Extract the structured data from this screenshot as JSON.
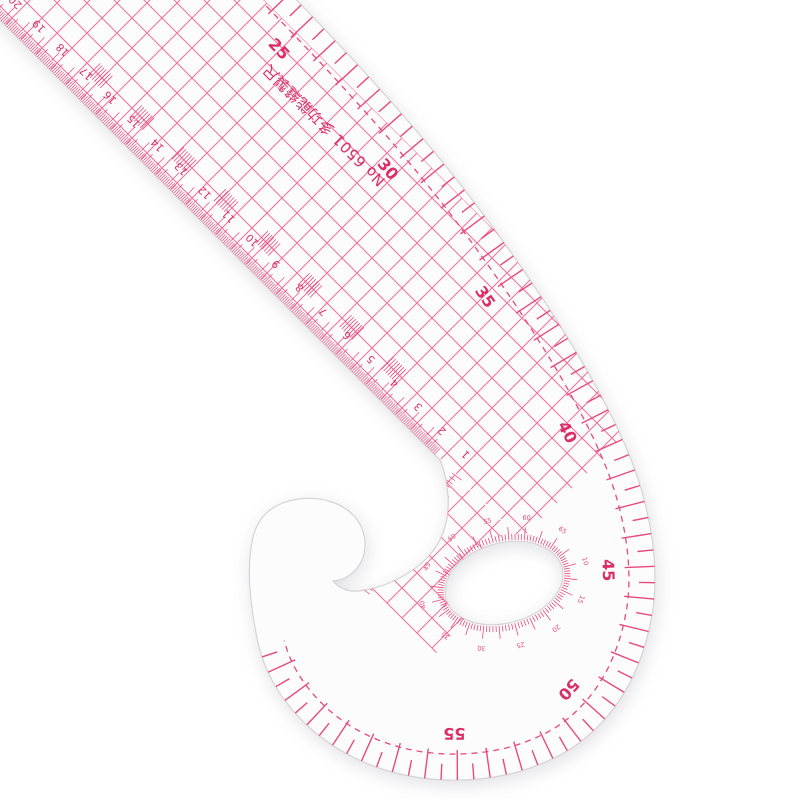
{
  "scene": {
    "background_color": "#ffffff",
    "description": "transparent plastic french curve sewing ruler photographed on white"
  },
  "ruler": {
    "title_text": "No 6501 多功能縫製尺",
    "colors": {
      "ink": "#e6497e",
      "ink_light": "#ef6f9b",
      "ink_dark": "#d92e68",
      "body": "#fdfcfc",
      "edge": "#d6d3d6"
    },
    "curve_scale": {
      "labels": [
        "25",
        "30",
        "35",
        "40",
        "45",
        "50",
        "55"
      ],
      "start_value": 25,
      "step": 5
    },
    "grid_numbers": [
      "1",
      "2",
      "3",
      "4",
      "5",
      "6",
      "7",
      "8",
      "9",
      "10",
      "11",
      "12",
      "13",
      "14",
      "15",
      "16",
      "17",
      "18",
      "19",
      "20"
    ],
    "protractor_numbers": [
      "10",
      "15",
      "20",
      "25",
      "30",
      "35",
      "40",
      "45",
      "50",
      "55",
      "60",
      "65"
    ]
  }
}
